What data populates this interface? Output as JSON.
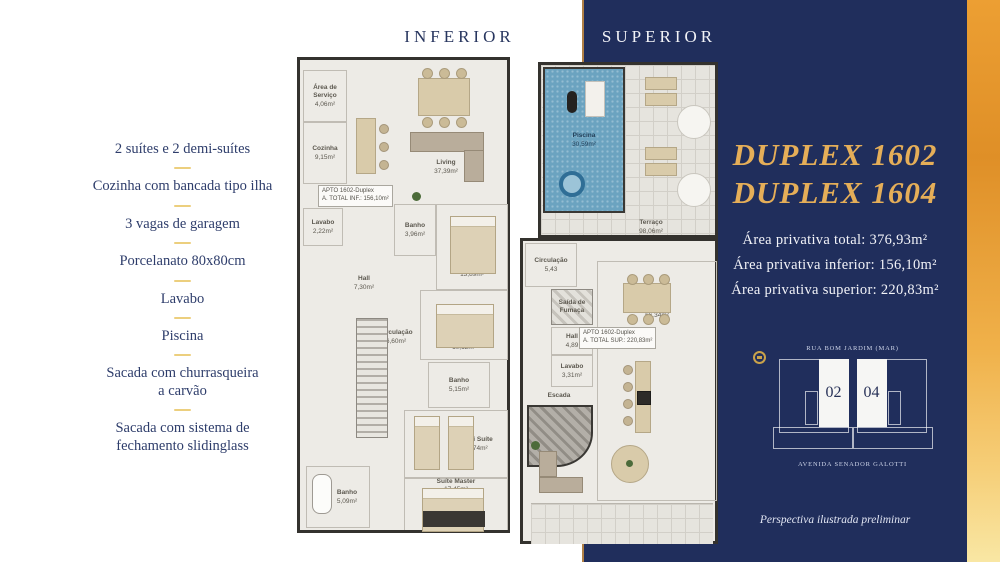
{
  "titles": {
    "inferior": "INFERIOR",
    "superior": "SUPERIOR"
  },
  "features": {
    "items": [
      "2 suítes e 2 demi-suítes",
      "Cozinha com bancada tipo ilha",
      "3 vagas de garagem",
      "Porcelanato 80x80cm",
      "Lavabo",
      "Piscina",
      "Sacada com churrasqueira\na carvão",
      "Sacada com sistema de\nfechamento slidinglass"
    ]
  },
  "panel": {
    "title_line1": "DUPLEX 1602",
    "title_line2": "DUPLEX 1604",
    "areas": [
      "Área privativa total: 376,93m²",
      "Área privativa inferior: 156,10m²",
      "Área privativa superior: 220,83m²"
    ]
  },
  "keyplan": {
    "street_top": "RUA BOM JARDIM (MAR)",
    "street_bottom": "AVENIDA SENADOR GALOTTI",
    "unit_left": "02",
    "unit_right": "04"
  },
  "footnote": "Perspectiva ilustrada preliminar",
  "plans": {
    "inferior": {
      "apto_label": "APTO 1602-Duplex",
      "total_label": "A. TOTAL INF.: 156,10m²",
      "rooms": [
        {
          "name": "Área de\nServiço",
          "area": "4,06m²"
        },
        {
          "name": "Cozinha",
          "area": "9,15m²"
        },
        {
          "name": "Living",
          "area": "37,39m²"
        },
        {
          "name": "Lavabo",
          "area": "2,22m²"
        },
        {
          "name": "Hall",
          "area": "7,30m²"
        },
        {
          "name": "Banho",
          "area": "3,96m²"
        },
        {
          "name": "Suíte 1",
          "area": "13,89m²"
        },
        {
          "name": "Demi Suíte",
          "area": "10,12m²"
        },
        {
          "name": "Circulação",
          "area": "6,60m²"
        },
        {
          "name": "Banho",
          "area": "5,15m²"
        },
        {
          "name": "Demi Suíte",
          "area": "11,74m²"
        },
        {
          "name": "Suíte Master",
          "area": "17,45m²"
        },
        {
          "name": "Banho",
          "area": "5,09m²"
        }
      ]
    },
    "superior": {
      "apto_label": "APTO 1602-Duplex",
      "total_label": "A. TOTAL SUP.: 220,83m²",
      "rooms": [
        {
          "name": "Piscina",
          "area": "30,59m²"
        },
        {
          "name": "Terraço",
          "area": "98,06m²"
        },
        {
          "name": "Circulação",
          "area": "5,43"
        },
        {
          "name": "Saída de\nFumaça",
          "area": ""
        },
        {
          "name": "Hall",
          "area": "4,89"
        },
        {
          "name": "Lavabo",
          "area": "3,31m²"
        },
        {
          "name": "Escada",
          "area": ""
        },
        {
          "name": "Gourmet",
          "area": "66,34m²"
        }
      ]
    }
  },
  "colors": {
    "navy": "#202e5c",
    "gold_title": "#e5ae58",
    "divider_gold": "#eccf7e",
    "strip_top": "#ec9f33",
    "strip_bottom": "#f9e7a4",
    "pool_blue": "#6ba3c0"
  }
}
